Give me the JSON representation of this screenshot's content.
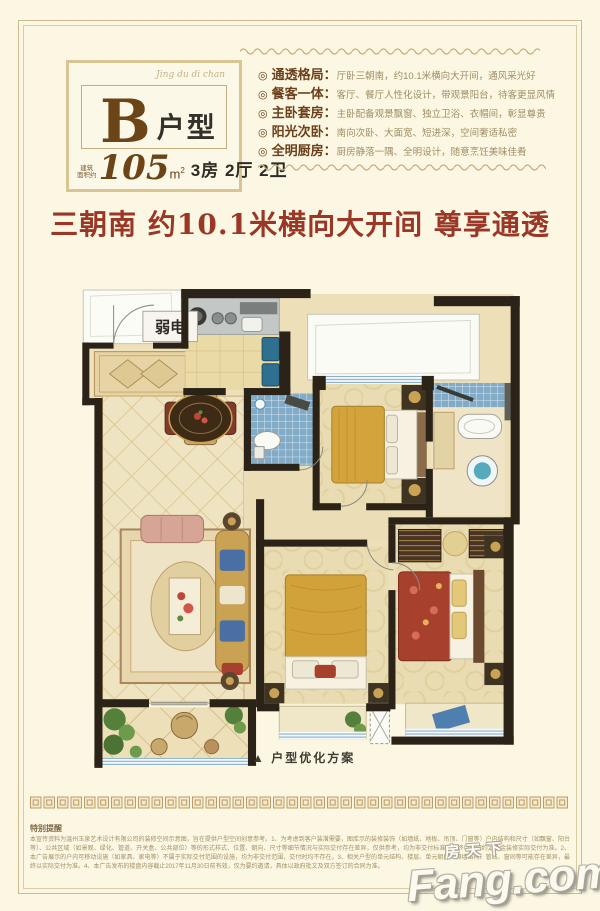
{
  "page": {
    "background": "#FBF7E2",
    "frame_color": "#CDBA8E"
  },
  "badge": {
    "script": "Jing du di chan",
    "letter": "B",
    "suffix": "户型",
    "area_note_line1": "建筑",
    "area_note_line2": "面积约",
    "area_value": "105",
    "area_unit": "m",
    "area_unit_sup": "2",
    "rooms_text": "3房 2厅 2卫"
  },
  "features_bullet": "◎",
  "features": [
    {
      "title": "通透格局：",
      "desc": "厅卧三朝南，约10.1米横向大开间，通风采光好"
    },
    {
      "title": "餐客一体：",
      "desc": "客厅、餐厅人性化设计，带观景阳台，待客更显风情"
    },
    {
      "title": "主卧套房：",
      "desc": "主卧配备观景飘窗、独立卫浴、衣帽间，彰显尊贵"
    },
    {
      "title": "阳光次卧：",
      "desc": "南向次卧、大面宽、短进深，空间奢适私密"
    },
    {
      "title": "全明厨房：",
      "desc": "厨房静落一隅、全明设计，随意烹饪美味佳肴"
    }
  ],
  "headline": {
    "text": "三朝南 约10.1米横向大开间 尊享通透",
    "color": "#9B3726"
  },
  "floorplan": {
    "weak_current_label": "弱电",
    "caption": "▲ 户型优化方案"
  },
  "footer": {
    "notice_title": "特别提醒",
    "notice_text": "本宣传资料为温州玉泉艺术设计有限公司的装修空间示意图，旨在提供户型空间创意参考。1、为考虑到客户装潢需要，图库示的装修装饰（如墙纸、地板、吊顶、门窗等）户内结构和尺寸（如飘窗、阳台等）、公共区域（如景观、绿化、管道、开关盒、公共部位）等的形式样式、位置、朝向、尺寸等细节情况与实际交付存在差异，仅供参考，均为非交付标准，最终以合同约定及金装修实际交付为准。2、本广告展示的户内可移动设施（如家具、家电等）不属于实际交付范围的设施，均为非交付范围，交付时均不存在。3、相关户型的单元结构、楼层、单元朝向、隔墙结构、管线、窗间等可能存在差异，最终以实际交付为准。4、本广告发布的楼盘内容截止2017年11月30日前有效，仅为要约邀请，具体以政府批文及双方签订的合同为准。",
    "watermark_cn": "房天下",
    "watermark_en": "Fang.com"
  }
}
